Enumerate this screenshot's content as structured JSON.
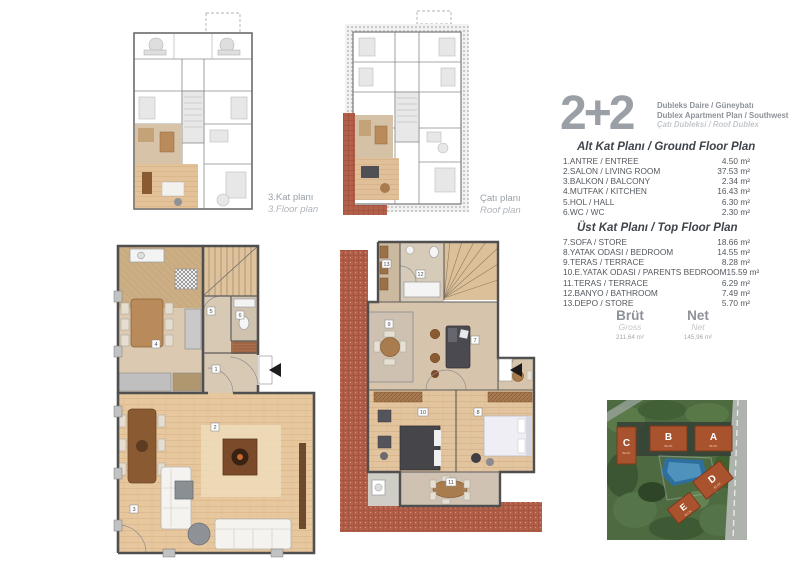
{
  "header": {
    "type_label": "2+2",
    "line1": "Dubleks Daire / Güneybatı",
    "line2": "Dublex Apartment Plan / Southwest",
    "line3": "Çatı Dubleksi / Roof Dublex"
  },
  "plans": {
    "floor3": {
      "label_tr": "3.Kat planı",
      "label_en": "3.Floor plan"
    },
    "roof": {
      "label_tr": "Çatı planı",
      "label_en": "Roof plan"
    }
  },
  "ground_floor": {
    "title": "Alt Kat Planı / Ground Floor Plan",
    "rooms": [
      {
        "name": "1.ANTRE / ENTREE",
        "area": "4.50 m²"
      },
      {
        "name": "2.SALON / LIVING ROOM",
        "area": "37.53 m²"
      },
      {
        "name": "3.BALKON / BALCONY",
        "area": "2.34 m²"
      },
      {
        "name": "4.MUTFAK / KITCHEN",
        "area": "16.43 m²"
      },
      {
        "name": "5.HOL / HALL",
        "area": "6.30 m²"
      },
      {
        "name": "6.WC / WC",
        "area": "2.30 m²"
      }
    ]
  },
  "top_floor": {
    "title": "Üst Kat Planı / Top Floor Plan",
    "rooms": [
      {
        "name": "7.SOFA / STORE",
        "area": "18.66 m²"
      },
      {
        "name": "8.YATAK ODASI / BEDROOM",
        "area": "14.55 m²"
      },
      {
        "name": "9.TERAS / TERRACE",
        "area": "8.28 m²"
      },
      {
        "name": "10.E.YATAK ODASI / PARENTS BEDROOM",
        "area": "15.59 m²"
      },
      {
        "name": "11.TERAS / TERRACE",
        "area": "6.29 m²"
      },
      {
        "name": "12.BANYO / BATHROOM",
        "area": "7.49 m²"
      },
      {
        "name": "13.DEPO / STORE",
        "area": "5.70 m²"
      }
    ]
  },
  "totals": {
    "brut_label": "Brüt",
    "brut_sub": "Gross",
    "brut_value": "211,64 m²",
    "net_label": "Net",
    "net_sub": "Net",
    "net_value": "145,96 m²"
  },
  "plan_numbers": {
    "n1": "1",
    "n2": "2",
    "n3": "3",
    "n4": "4",
    "n5": "5",
    "n6": "6",
    "n7": "7",
    "n8": "8",
    "n9": "9",
    "n10": "10",
    "n11": "11",
    "n12": "12",
    "n13": "13"
  },
  "site": {
    "blok_label": "BLOK",
    "blocks": [
      {
        "letter": "C"
      },
      {
        "letter": "B"
      },
      {
        "letter": "A"
      },
      {
        "letter": "D"
      },
      {
        "letter": "E"
      }
    ]
  },
  "colors": {
    "highlight_tan": "#d8c5aa",
    "wood_floor": "#e6c69e",
    "roof_brick": "#b2604a",
    "block_orange": "#a8532d",
    "wall_gray": "#4f4f4f",
    "text_gray": "#9aa0a6"
  }
}
